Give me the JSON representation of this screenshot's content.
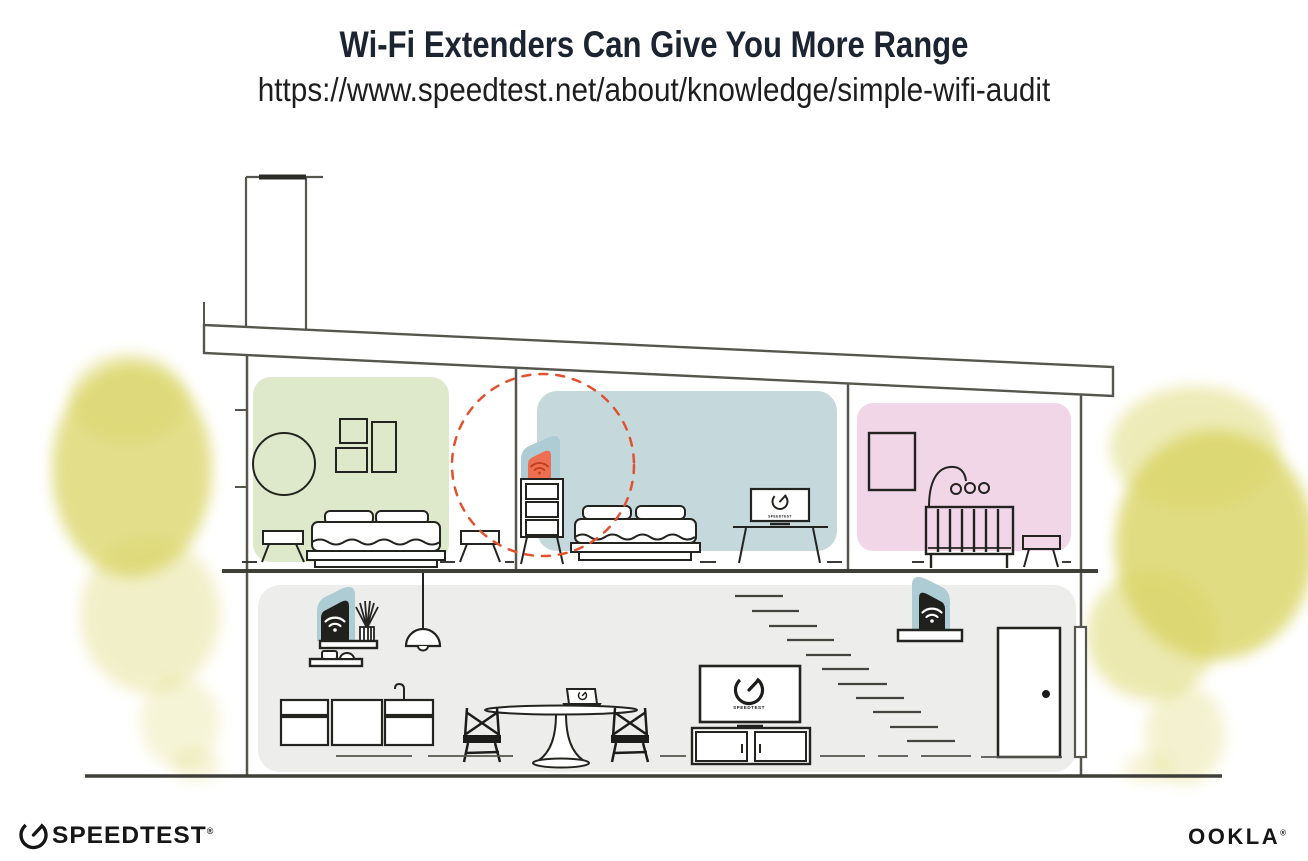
{
  "header": {
    "title": "Wi-Fi Extenders Can Give You More Range",
    "url": "https://www.speedtest.net/about/knowledge/simple-wifi-audit"
  },
  "illustration": {
    "description": "Cross-section of a two-story house showing Wi-Fi extender placement and coverage",
    "rooms": [
      {
        "id": "bedroom-left",
        "wash_color": "#dee9cc"
      },
      {
        "id": "bedroom-middle",
        "wash_color": "#c5d9dd"
      },
      {
        "id": "nursery",
        "wash_color": "#f1d6e8"
      },
      {
        "id": "lower-floor",
        "wash_color": "#ededeb"
      }
    ],
    "devices": [
      {
        "id": "wifi-extender-upstairs",
        "body_color": "#ec6f52",
        "halo_color": "#adccd3",
        "icon": "wifi-icon",
        "range_ring_color": "#e2512e"
      },
      {
        "id": "wifi-router-lower-left",
        "body_color": "#20201d",
        "halo_color": "#adccd3",
        "icon": "wifi-icon"
      },
      {
        "id": "wifi-extender-lower-right",
        "body_color": "#20201d",
        "halo_color": "#adccd3",
        "icon": "wifi-icon"
      }
    ],
    "screens": {
      "speedtest_label": "SPEEDTEST"
    },
    "foliage_color": "#d9d464",
    "outline_color": "#56564f"
  },
  "footer": {
    "speedtest": {
      "brand": "SPEEDTEST",
      "reg": "®",
      "icon": "speedtest-gauge-icon"
    },
    "ookla": {
      "brand": "OOKLA",
      "reg": "®"
    }
  }
}
